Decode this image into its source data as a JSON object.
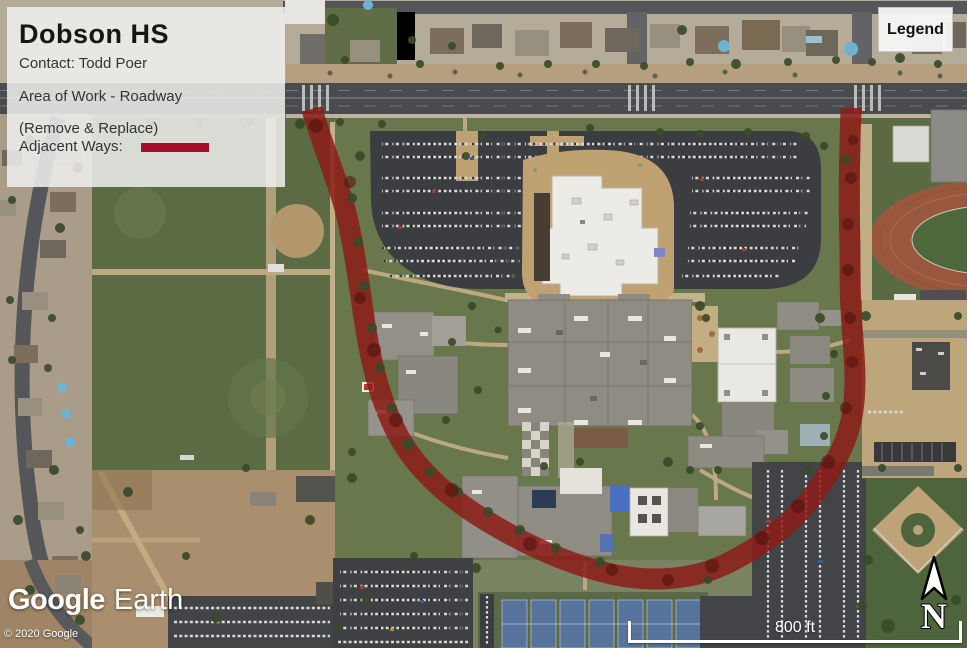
{
  "info_panel": {
    "title": "Dobson HS",
    "contact": "Contact: Todd Poer",
    "area_of_work": "Area of Work - Roadway",
    "remove_replace": "(Remove & Replace)",
    "adjacent_ways": "Adjacent Ways:",
    "swatch_color": "#a50f2b"
  },
  "legend_button": {
    "label": "Legend"
  },
  "map_overlay": {
    "roadway_highlight_color": "#8c1c18",
    "highlight_opacity": "0.85"
  },
  "watermark": {
    "brand": "Google",
    "product": "Earth"
  },
  "attribution": {
    "copyright": "© 2020 Google"
  },
  "scale_bar": {
    "label": "800 ft"
  },
  "compass": {
    "label": "N"
  }
}
